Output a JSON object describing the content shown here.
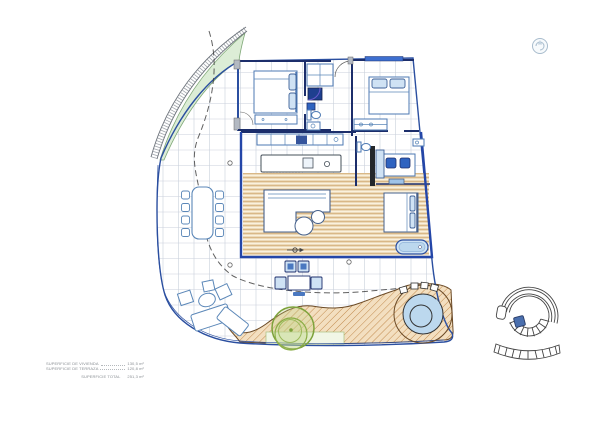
{
  "legend": {
    "rows": [
      {
        "label": "SUPERFICIE DE VIVIENDA",
        "value": "130,5 m²"
      },
      {
        "label": "SUPERFICIE DE TERRAZA",
        "value": "120,8 m²"
      }
    ],
    "total_row": {
      "label": "SUPERFICIE TOTAL",
      "value": "251,3 m²"
    }
  },
  "icons": {
    "compass": "compass-icon",
    "stair_detail": "spiral-staircase-icon",
    "tree": "tree-icon",
    "jacuzzi": "jacuzzi-icon",
    "sail_canopy": "sail-canopy",
    "bathtub": "bathtub-icon"
  },
  "colors": {
    "boundary_blue": "#2b4fa0",
    "wall_navy": "#1c2e6b",
    "furniture_blue": "#4d79b3",
    "water_blue": "#bcd8ee",
    "deck_tan": "#d9b887",
    "deck_light": "#faf1dd",
    "sand_fill": "#f3dfc0",
    "sand_hatch": "#c28b4e",
    "sail_green": "#dcedd6",
    "tree_olive": "#7da23b",
    "grid_gray": "#c9d0db",
    "dash_gray": "#3a3a3a"
  }
}
